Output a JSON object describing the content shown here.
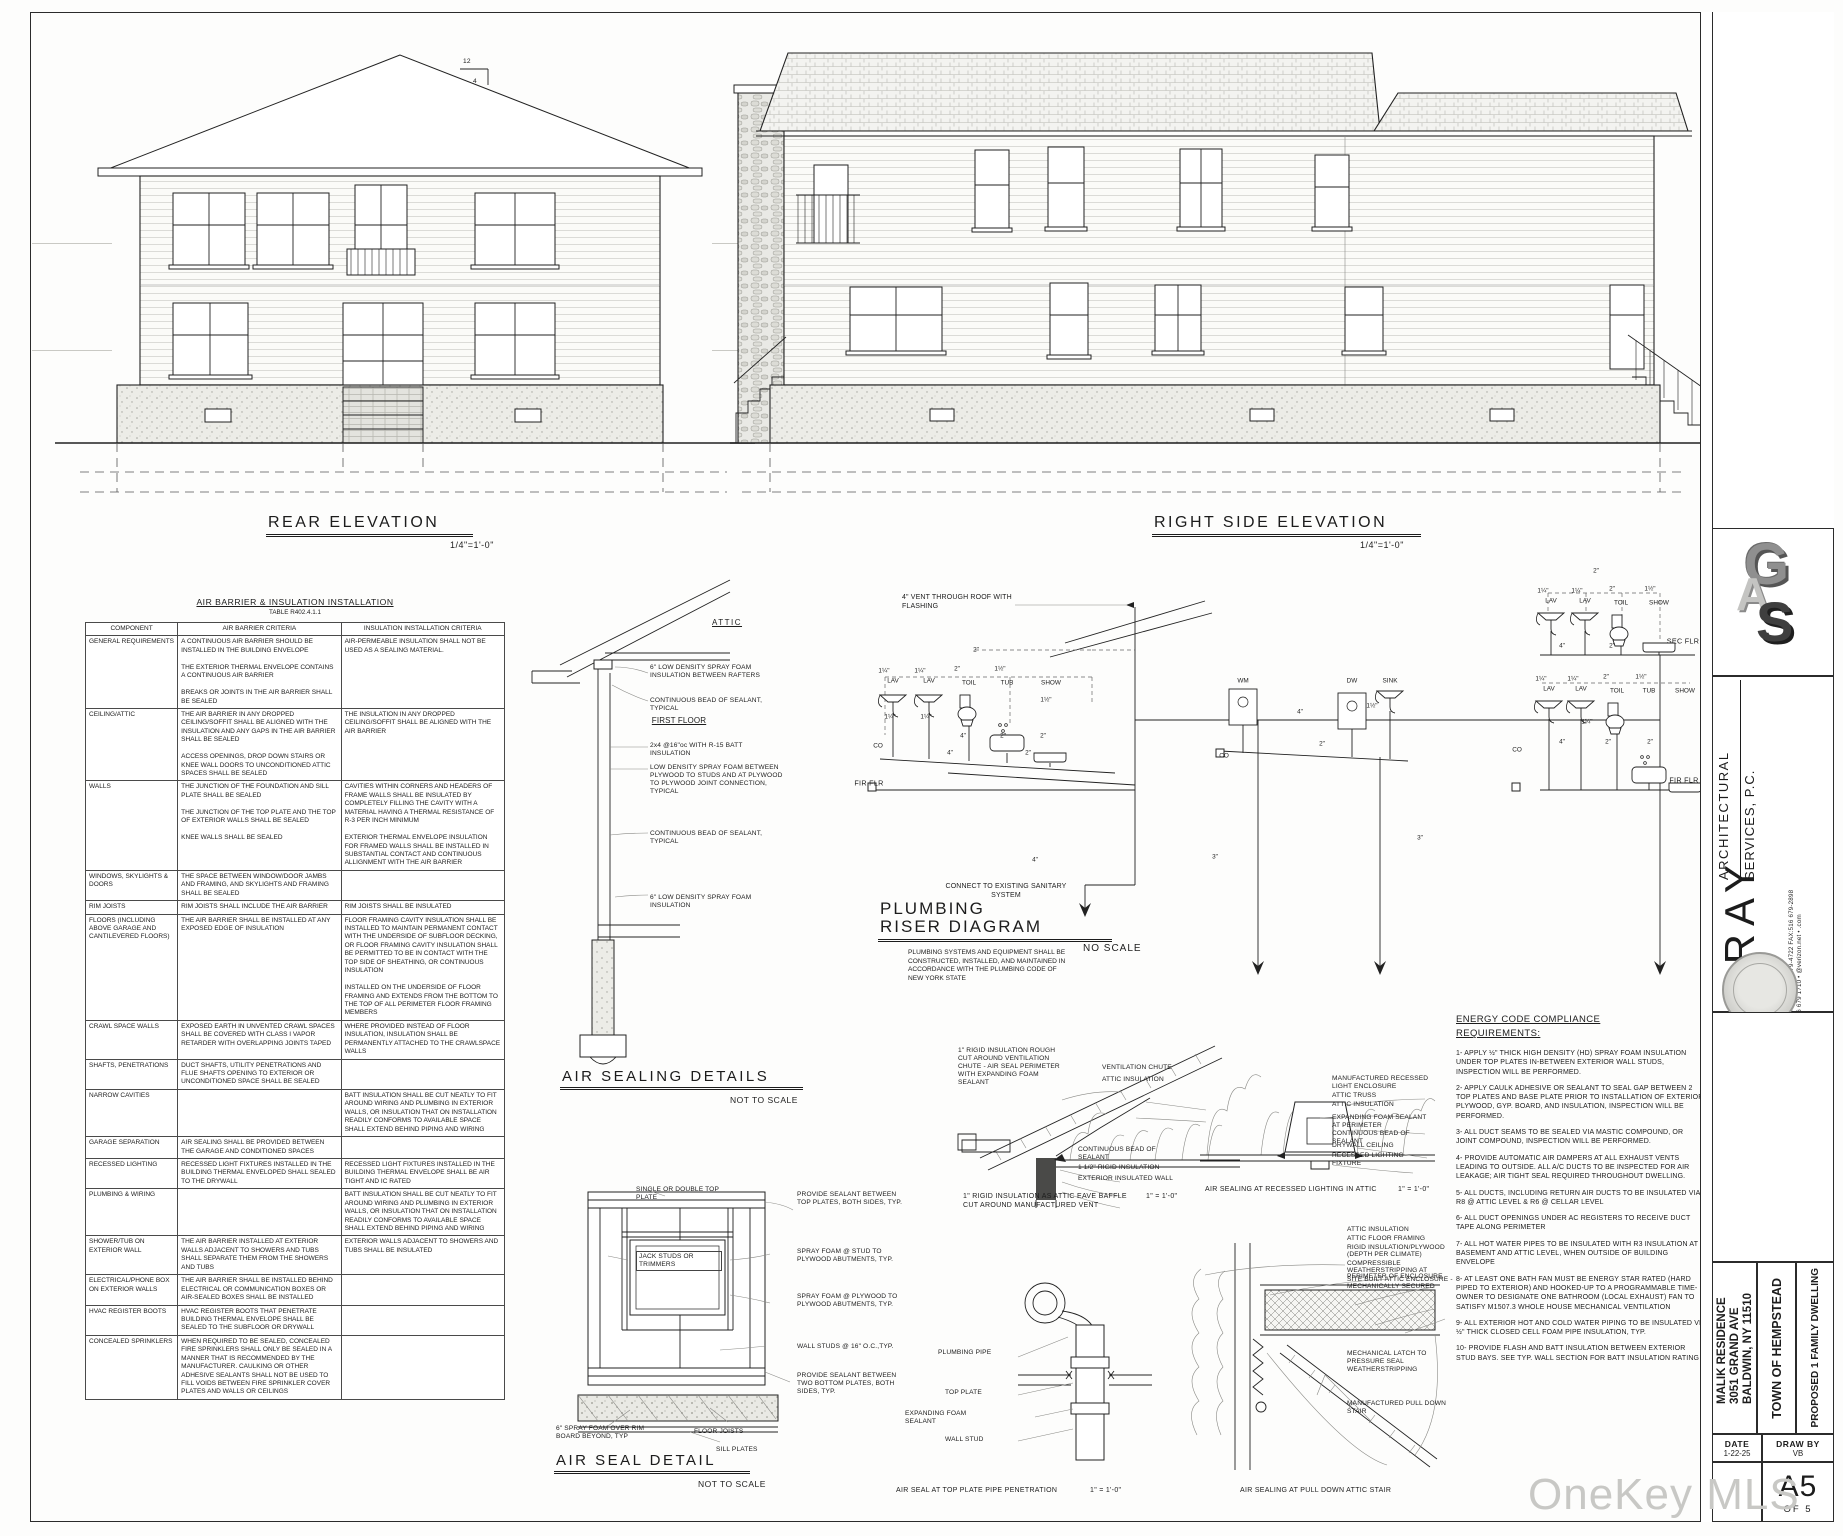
{
  "watermark": "OneKey MLS",
  "rear": {
    "title": "REAR ELEVATION",
    "scale": "1/4\"=1'-0\"",
    "pitch_rise": "12",
    "pitch_run": "4"
  },
  "right_side": {
    "title": "RIGHT SIDE ELEVATION",
    "scale": "1/4\"=1'-0\""
  },
  "spec_table": {
    "title": "AIR BARRIER & INSULATION INSTALLATION",
    "subtitle": "TABLE R402.4.1.1",
    "columns": [
      "COMPONENT",
      "AIR BARRIER CRITERIA",
      "INSULATION INSTALLATION CRITERIA"
    ],
    "rows": [
      [
        "GENERAL REQUIREMENTS",
        "A CONTINUOUS AIR BARRIER SHOULD BE INSTALLED IN THE BUILDING ENVELOPE\n\nTHE EXTERIOR THERMAL ENVELOPE CONTAINS A CONTINUOUS AIR BARRIER\n\nBREAKS OR JOINTS IN THE AIR BARRIER SHALL BE SEALED",
        "AIR-PERMEABLE INSULATION SHALL NOT BE USED AS A SEALING MATERIAL."
      ],
      [
        "CEILING/ATTIC",
        "THE AIR BARRIER IN ANY DROPPED CEILING/SOFFIT SHALL BE ALIGNED WITH THE INSULATION AND ANY GAPS IN THE AIR BARRIER SHALL BE SEALED\n\nACCESS OPENINGS, DROP DOWN STAIRS OR KNEE WALL DOORS TO UNCONDITIONED ATTIC SPACES SHALL BE SEALED",
        "THE INSULATION IN ANY DROPPED CEILING/SOFFIT SHALL BE ALIGNED WITH THE AIR BARRIER"
      ],
      [
        "WALLS",
        "THE JUNCTION OF THE FOUNDATION AND SILL PLATE SHALL BE SEALED\n\nTHE JUNCTION OF THE TOP PLATE AND THE TOP OF EXTERIOR WALLS SHALL BE SEALED\n\nKNEE WALLS SHALL BE SEALED",
        "CAVITIES WITHIN CORNERS AND HEADERS OF FRAME WALLS SHALL BE INSULATED BY COMPLETELY FILLING THE CAVITY WITH A MATERIAL HAVING A THERMAL RESISTANCE OF R-3 PER INCH MINIMUM\n\nEXTERIOR THERMAL ENVELOPE INSULATION FOR FRAMED WALLS SHALL BE INSTALLED IN SUBSTANTIAL CONTACT AND CONTINUOUS ALLIGNMENT WITH THE AIR BARRIER"
      ],
      [
        "WINDOWS, SKYLIGHTS & DOORS",
        "THE SPACE BETWEEN WINDOW/DOOR JAMBS AND FRAMING, AND SKYLIGHTS AND FRAMING SHALL BE SEALED",
        ""
      ],
      [
        "RIM JOISTS",
        "RIM JOISTS SHALL INCLUDE THE AIR BARRIER",
        "RIM JOISTS SHALL BE INSULATED"
      ],
      [
        "FLOORS (INCLUDING ABOVE GARAGE AND CANTILEVERED FLOORS)",
        "THE AIR BARRIER SHALL BE INSTALLED AT ANY EXPOSED EDGE OF INSULATION",
        "FLOOR FRAMING CAVITY INSULATION SHALL BE INSTALLED TO MAINTAIN PERMANENT CONTACT WITH THE UNDERSIDE OF SUBFLOOR DECKING, OR FLOOR FRAMING CAVITY INSULATION SHALL BE PERMITTED TO BE IN CONTACT WITH THE TOP SIDE OF SHEATHING, OR CONTINUOUS INSULATION\n\nINSTALLED ON THE UNDERSIDE OF FLOOR FRAMING AND EXTENDS FROM THE BOTTOM TO THE TOP OF ALL PERIMETER FLOOR FRAMING MEMBERS"
      ],
      [
        "CRAWL SPACE WALLS",
        "EXPOSED EARTH IN UNVENTED CRAWL SPACES SHALL BE COVERED WITH CLASS I VAPOR RETARDER WITH OVERLAPPING JOINTS TAPED",
        "WHERE PROVIDED INSTEAD OF FLOOR INSULATION, INSULATION SHALL BE PERMANENTLY ATTACHED TO THE CRAWLSPACE WALLS"
      ],
      [
        "SHAFTS, PENETRATIONS",
        "DUCT SHAFTS, UTILITY PENETRATIONS AND FLUE SHAFTS OPENING TO EXTERIOR OR UNCONDITIONED SPACE SHALL BE SEALED",
        ""
      ],
      [
        "NARROW CAVITIES",
        "",
        "BATT INSULATION SHALL BE CUT NEATLY TO FIT AROUND WIRING AND PLUMBING IN EXTERIOR WALLS, OR INSULATION THAT ON INSTALLATION READILY CONFORMS TO AVAILABLE SPACE SHALL EXTEND BEHIND PIPING AND WIRING"
      ],
      [
        "GARAGE SEPARATION",
        "AIR SEALING SHALL BE PROVIDED BETWEEN THE GARAGE AND CONDITIONED SPACES",
        ""
      ],
      [
        "RECESSED LIGHTING",
        "RECESSED LIGHT FIXTURES INSTALLED IN THE BUILDING THERMAL ENVELOPED SHALL SEALED TO THE DRYWALL",
        "RECESSED LIGHT FIXTURES INSTALLED IN THE BUILDING THERMAL ENVELOPE SHALL BE AIR TIGHT AND IC RATED"
      ],
      [
        "PLUMBING & WIRING",
        "",
        "BATT INSULATION SHALL BE CUT NEATLY TO FIT AROUND WIRING AND PLUMBING IN EXTERIOR WALLS, OR INSULATION THAT ON INSTALLATION READILY CONFORMS TO AVAILABLE SPACE SHALL EXTEND BEHIND PIPING AND WIRING"
      ],
      [
        "SHOWER/TUB ON EXTERIOR WALL",
        "THE AIR BARRIER INSTALLED AT EXTERIOR WALLS ADJACENT TO SHOWERS AND TUBS SHALL SEPARATE THEM FROM THE SHOWERS AND TUBS",
        "EXTERIOR WALLS ADJACENT TO SHOWERS AND TUBS SHALL BE INSULATED"
      ],
      [
        "ELECTRICAL/PHONE BOX ON EXTERIOR WALLS",
        "THE AIR BARRIER SHALL BE INSTALLED BEHIND ELECTRICAL OR COMMUNICATION BOXES OR AIR-SEALED BOXES SHALL BE INSTALLED",
        ""
      ],
      [
        "HVAC REGISTER BOOTS",
        "HVAC REGISTER BOOTS THAT PENETRATE BUILDING THERMAL ENVELOPE SHALL BE SEALED TO THE SUBFLOOR OR DRYWALL",
        ""
      ],
      [
        "CONCEALED SPRINKLERS",
        "WHEN REQUIRED TO BE SEALED, CONCEALED FIRE SPRINKLERS SHALL ONLY BE SEALED IN A MANNER THAT IS RECOMMENDED BY THE MANUFACTURER. CAULKING OR OTHER ADHESIVE SEALANTS SHALL NOT BE USED TO FILL VOIDS BETWEEN FIRE SPRINKLER COVER PLATES AND WALLS OR CEILINGS",
        ""
      ]
    ]
  },
  "air_sealing": {
    "title": "AIR SEALING DETAILS",
    "scale": "NOT TO SCALE",
    "attic": "ATTIC",
    "first_floor": "FIRST FLOOR",
    "labels": [
      "6\" LOW DENSITY SPRAY FOAM INSULATION BETWEEN RAFTERS",
      "CONTINUOUS BEAD OF SEALANT, TYPICAL",
      "2x4 @16\"oc WITH R-15 BATT INSULATION",
      "LOW DENSITY SPRAY FOAM BETWEEN PLYWOOD TO STUDS AND AT PLYWOOD TO PLYWOOD JOINT CONNECTION, TYPICAL",
      "CONTINUOUS BEAD OF SEALANT, TYPICAL",
      "6\" LOW DENSITY SPRAY FOAM INSULATION"
    ]
  },
  "riser": {
    "title1": "PLUMBING",
    "title2": "RISER DIAGRAM",
    "scale": "NO SCALE",
    "note": "PLUMBING SYSTEMS AND EQUIPMENT SHALL BE CONSTRUCTED, INSTALLED, AND MAINTAINED IN ACCORDANCE WITH THE PLUMBING CODE OF NEW YORK STATE",
    "vent_label": "4\" VENT THROUGH ROOF WITH FLASHING",
    "connect_label": "CONNECT TO EXISTING SANITARY SYSTEM",
    "labels": [
      {
        "t": "LAV",
        "x": 893,
        "y": 681
      },
      {
        "t": "LAV",
        "x": 929,
        "y": 681
      },
      {
        "t": "TOIL",
        "x": 969,
        "y": 683
      },
      {
        "t": "TUB",
        "x": 1007,
        "y": 683
      },
      {
        "t": "SHOW",
        "x": 1051,
        "y": 683
      },
      {
        "t": "1¼\"",
        "x": 884,
        "y": 671
      },
      {
        "t": "1¼\"",
        "x": 920,
        "y": 671
      },
      {
        "t": "2\"",
        "x": 957,
        "y": 669
      },
      {
        "t": "1½\"",
        "x": 1000,
        "y": 669
      },
      {
        "t": "2\"",
        "x": 976,
        "y": 650
      },
      {
        "t": "1¼\"",
        "x": 890,
        "y": 717
      },
      {
        "t": "1¼\"",
        "x": 926,
        "y": 717
      },
      {
        "t": "1½\"",
        "x": 1046,
        "y": 700
      },
      {
        "t": "4\"",
        "x": 963,
        "y": 736
      },
      {
        "t": "2\"",
        "x": 1003,
        "y": 736
      },
      {
        "t": "2\"",
        "x": 1043,
        "y": 736
      },
      {
        "t": "CO",
        "x": 878,
        "y": 746
      },
      {
        "t": "4\"",
        "x": 950,
        "y": 753
      },
      {
        "t": "2\"",
        "x": 1028,
        "y": 753
      },
      {
        "t": "FIR FLR",
        "x": 869,
        "y": 783,
        "c": "pb"
      },
      {
        "t": "4\"",
        "x": 1300,
        "y": 712
      },
      {
        "t": "WM",
        "x": 1243,
        "y": 681
      },
      {
        "t": "DW",
        "x": 1352,
        "y": 681
      },
      {
        "t": "SINK",
        "x": 1390,
        "y": 681
      },
      {
        "t": "2\"",
        "x": 1322,
        "y": 744
      },
      {
        "t": "1½\"",
        "x": 1372,
        "y": 706
      },
      {
        "t": "4\"",
        "x": 1035,
        "y": 860
      },
      {
        "t": "3\"",
        "x": 1215,
        "y": 857
      },
      {
        "t": "3\"",
        "x": 1420,
        "y": 838
      },
      {
        "t": "LAV",
        "x": 1551,
        "y": 601
      },
      {
        "t": "LAV",
        "x": 1585,
        "y": 601
      },
      {
        "t": "TOIL",
        "x": 1621,
        "y": 603
      },
      {
        "t": "SHOW",
        "x": 1659,
        "y": 603
      },
      {
        "t": "1¼\"",
        "x": 1543,
        "y": 591
      },
      {
        "t": "1¼\"",
        "x": 1577,
        "y": 591
      },
      {
        "t": "2\"",
        "x": 1612,
        "y": 589
      },
      {
        "t": "1½\"",
        "x": 1650,
        "y": 589
      },
      {
        "t": "2\"",
        "x": 1596,
        "y": 571
      },
      {
        "t": "4\"",
        "x": 1562,
        "y": 646
      },
      {
        "t": "2\"",
        "x": 1612,
        "y": 646
      },
      {
        "t": "SEC FLR",
        "x": 1683,
        "y": 641,
        "c": "pb"
      },
      {
        "t": "LAV",
        "x": 1549,
        "y": 689
      },
      {
        "t": "LAV",
        "x": 1581,
        "y": 689
      },
      {
        "t": "TOIL",
        "x": 1617,
        "y": 691
      },
      {
        "t": "TUB",
        "x": 1649,
        "y": 691
      },
      {
        "t": "SHOW",
        "x": 1685,
        "y": 691
      },
      {
        "t": "1¼\"",
        "x": 1541,
        "y": 679
      },
      {
        "t": "1¼\"",
        "x": 1573,
        "y": 679
      },
      {
        "t": "2\"",
        "x": 1606,
        "y": 677
      },
      {
        "t": "1½\"",
        "x": 1641,
        "y": 677
      },
      {
        "t": "4\"",
        "x": 1562,
        "y": 742
      },
      {
        "t": "2\"",
        "x": 1608,
        "y": 742
      },
      {
        "t": "2\"",
        "x": 1650,
        "y": 742
      },
      {
        "t": "1¼\"",
        "x": 1587,
        "y": 722
      },
      {
        "t": "FIR FLR",
        "x": 1684,
        "y": 780,
        "c": "pb"
      },
      {
        "t": "CO",
        "x": 1517,
        "y": 750
      },
      {
        "t": "CO",
        "x": 1224,
        "y": 756
      }
    ]
  },
  "air_seal_detail": {
    "title": "AIR SEAL DETAIL",
    "scale": "NOT TO SCALE",
    "labels": [
      "SINGLE OR DOUBLE TOP PLATE",
      "PROVIDE SEALANT BETWEEN TOP PLATES, BOTH SIDES, TYP.",
      "SPRAY FOAM @ STUD TO PLYWOOD ABUTMENTS, TYP.",
      "JACK STUDS OR TRIMMERS",
      "SPRAY FOAM @ PLYWOOD TO PLYWOOD ABUTMENTS, TYP.",
      "WALL STUDS @ 16\" O.C.,TYP.",
      "PROVIDE SEALANT BETWEEN TWO BOTTOM PLATES, BOTH SIDES, TYP.",
      "6\" SPRAY FOAM OVER RIM BOARD BEYOND, TYP",
      "FLOOR JOISTS",
      "SILL PLATES"
    ]
  },
  "eave_detail": {
    "labels": [
      "1\" RIGID INSULATION ROUGH CUT AROUND VENTILATION CHUTE - AIR SEAL PERIMETER WITH EXPANDING FOAM SEALANT",
      "VENTILATION CHUTE",
      "ATTIC INSULATION",
      "CONTINUOUS BEAD OF SEALANT",
      "1 1/2\" RIGID INSULATION",
      "EXTERIOR INSULATED WALL"
    ],
    "caption": "1\" RIGID INSULATION AS ATTIC EAVE BAFFLE CUT AROUND MANUFACTURED VENT",
    "caption_scale": "1\" = 1'-0\""
  },
  "recessed_detail": {
    "labels": [
      "MANUFACTURED RECESSED LIGHT ENCLOSURE",
      "ATTIC TRUSS",
      "ATTIC INSULATION",
      "EXPANDING FOAM SEALANT AT PERIMETER",
      "CONTINUOUS BEAD OF SEALANT",
      "DRYWALL CEILING",
      "RECESSED LIGHTING FIXTURE"
    ],
    "caption": "AIR SEALING AT RECESSED LIGHTING IN ATTIC",
    "caption_scale": "1\" = 1'-0\""
  },
  "stair_detail": {
    "labels": [
      "ATTIC INSULATION",
      "ATTIC FLOOR FRAMING",
      "RIGID INSULATION/PLYWOOD (DEPTH PER CLIMATE)",
      "COMPRESSIBLE WEATHERSTRIPPING AT PERIMETER OF ENCLOSURE",
      "SITE BUILT ATTIC ENCLOSURE - MECHANICALLY SECURED",
      "MECHANICAL LATCH TO PRESSURE SEAL WEATHERSTRIPPING",
      "MANUFACTURED PULL DOWN STAIR"
    ],
    "caption": "AIR SEALING AT PULL DOWN ATTIC STAIR"
  },
  "pipe_detail": {
    "labels": [
      "PLUMBING PIPE",
      "TOP PLATE",
      "EXPANDING FOAM SEALANT",
      "WALL STUD"
    ],
    "caption": "AIR SEAL AT TOP PLATE PIPE PENETRATION",
    "caption_scale": "1\" = 1'-0\""
  },
  "energy": {
    "title1": "ENERGY CODE COMPLIANCE",
    "title2": "REQUIREMENTS:",
    "items": [
      "1- APPLY ½\" THICK HIGH DENSITY (HD) SPRAY FOAM INSULATION UNDER TOP PLATES IN-BETWEEN EXTERIOR WALL STUDS, INSPECTION WILL BE PERFORMED.",
      "2- APPLY CAULK ADHESIVE OR SEALANT TO SEAL GAP BETWEEN 2 TOP PLATES AND BASE PLATE PRIOR TO INSTALLATION OF EXTERIOR PLYWOOD, GYP. BOARD, AND INSULATION, INSPECTION WILL BE PERFORMED.",
      "3- ALL DUCT SEAMS TO BE SEALED VIA MASTIC COMPOUND, OR JOINT COMPOUND, INSPECTION WILL BE PERFORMED.",
      "4- PROVIDE AUTOMATIC AIR DAMPERS AT ALL EXHAUST VENTS LEADING TO OUTSIDE.  ALL A/C DUCTS TO BE INSPECTED FOR AIR LEAKAGE; AIR TIGHT SEAL REQUIRED THROUGHOUT DWELLING.",
      "5- ALL DUCTS, INCLUDING RETURN AIR DUCTS TO BE INSULATED VIA R8 @ ATTIC LEVEL & R6 @ CELLAR LEVEL",
      "6- ALL DUCT OPENINGS UNDER AC REGISTERS TO RECEIVE DUCT TAPE ALONG PERIMETER",
      "7- ALL HOT WATER PIPES TO BE INSULATED WITH R3 INSULATION AT BASEMENT AND ATTIC LEVEL, WHEN OUTSIDE OF BUILDING ENVELOPE",
      "8- AT LEAST ONE BATH FAN MUST BE ENERGY STAR RATED (HARD PIPED TO EXTERIOR) AND HOOKED-UP TO A PROGRAMMABLE TIME- OWNER TO DESIGNATE ONE BATHROOM (LOCAL EXHAUST) FAN TO SATISFY M1507.3 WHOLE HOUSE MECHANICAL VENTILATION",
      "9- ALL EXTERIOR HOT AND COLD WATER PIPING TO BE INSULATED VIA ½\" THICK CLOSED CELL FOAM PIPE INSULATION, TYP.",
      "10- PROVIDE FLASH AND BATT INSULATION BETWEEN EXTERIOR STUD BAYS. SEE TYP. WALL SECTION FOR BATT INSULATION RATING"
    ]
  },
  "title_block": {
    "logo": {
      "l1": "G",
      "l2": "A",
      "l3": "S"
    },
    "firm_name": "GRAY",
    "firm_line1": "ARCHITECTURAL",
    "firm_line2": "SERVICES, P.C.",
    "contact1": "PHONE:516 679-4722 FAX:516 679-2898",
    "contact2": "516 679 1710 • @verizon.net • .com",
    "client": "MALIK RESIDENCE",
    "address1": "3051 GRAND AVE",
    "address2": "BALDWIN, NY 11510",
    "municipality": "TOWN OF HEMPSTEAD",
    "description": "PROPOSED 1 FAMILY DWELLING",
    "date_label": "DATE",
    "date": "1-22-25",
    "drawby_label": "DRAW BY",
    "drawby": "VB",
    "sheet_number": "A5",
    "sheet_of": "OF 5"
  }
}
